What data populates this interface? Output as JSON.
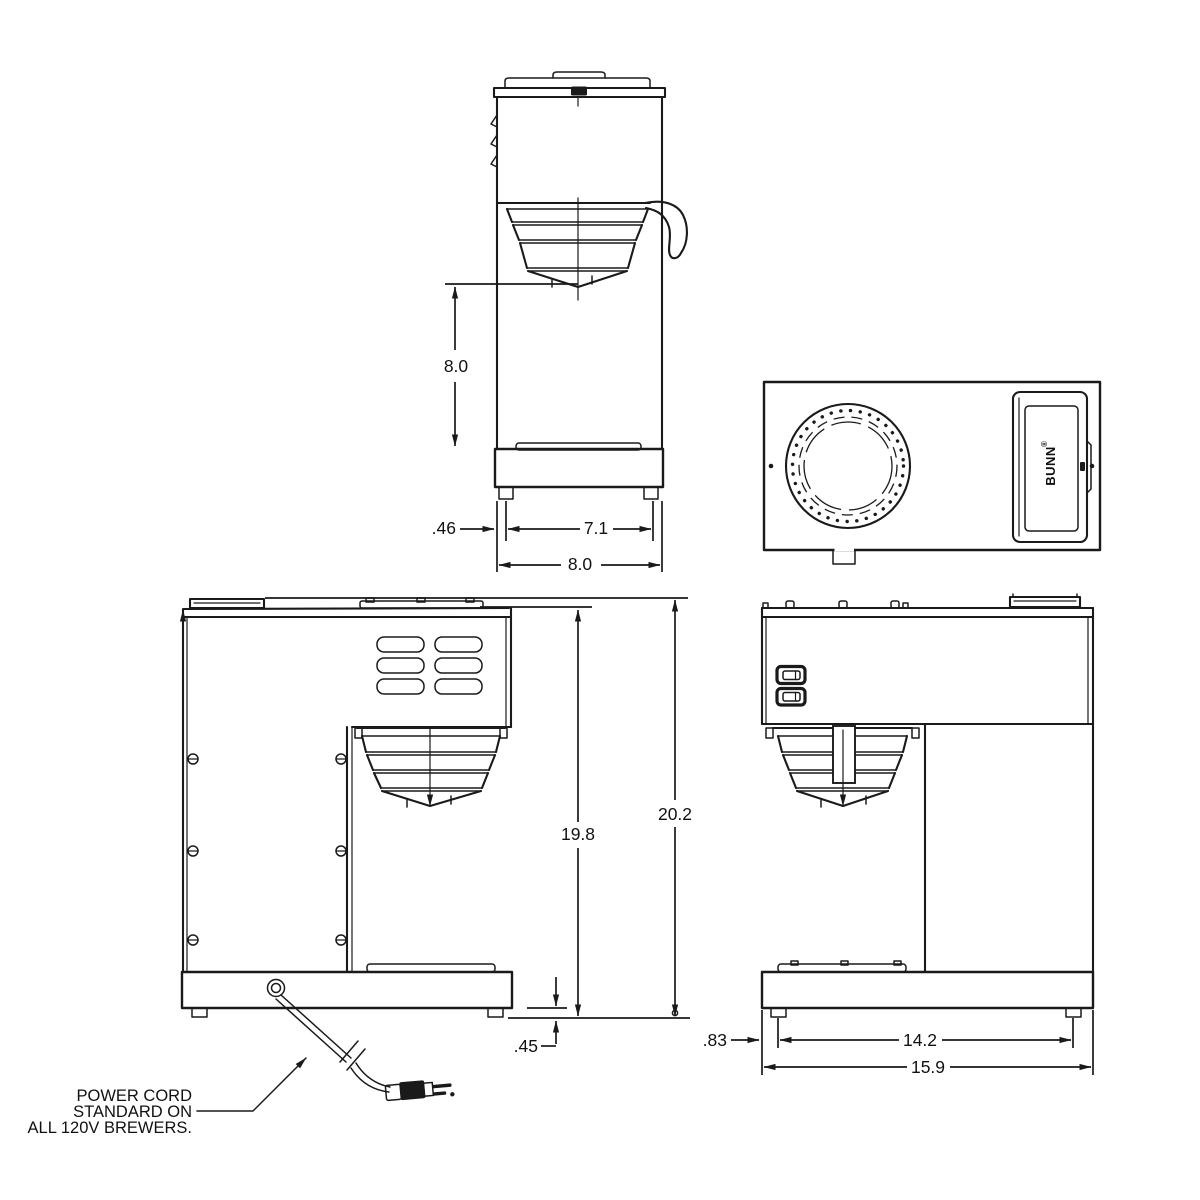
{
  "document": {
    "kind": "technical-dimension-drawing",
    "subject": "pourover coffee brewer - four orthographic views"
  },
  "colors": {
    "line": "#1a1a1a",
    "background": "#ffffff",
    "text": "#111111"
  },
  "logo": {
    "text": "BUNN",
    "reg": "®"
  },
  "side_view": {
    "dim_height_to_funnel": "8.0",
    "dim_foot_inset": ".46",
    "dim_foot_spacing": "7.1",
    "dim_depth": "8.0"
  },
  "elevation": {
    "dim_body_height": "19.8",
    "dim_total_height": "20.2",
    "dim_foot_height": ".45"
  },
  "front_view": {
    "dim_foot_inset": ".83",
    "dim_foot_spacing": "14.2",
    "dim_width": "15.9"
  },
  "note": {
    "line1": "POWER CORD",
    "line2": "STANDARD ON",
    "line3": "ALL 120V BREWERS."
  }
}
